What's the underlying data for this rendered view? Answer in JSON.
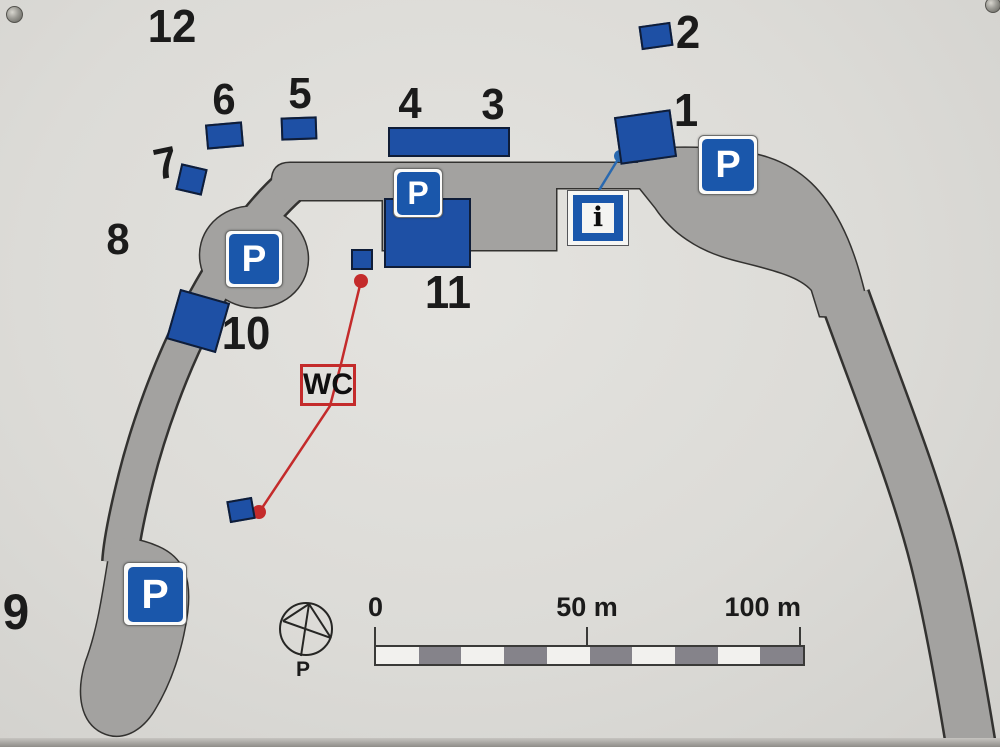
{
  "colors": {
    "background": "#dcdbd7",
    "road": "#a3a2a0",
    "road_outline": "#333230",
    "building": "#1e50a5",
    "building_outline": "#0f1d38",
    "sign_blue": "#1a57ab",
    "red": "#c42b2b",
    "connector_blue": "#2969b0",
    "ink": "#1b1b1b",
    "scale_gray": "#85838a",
    "scale_white": "#f2f1ee"
  },
  "labels": {
    "parking": "P",
    "info": "i",
    "wc": "WC",
    "compass_north": "P"
  },
  "site_numbers": [
    {
      "label": "12",
      "cx": 172,
      "cy": 26,
      "size": 46,
      "rotate": 0
    },
    {
      "label": "2",
      "cx": 688,
      "cy": 32,
      "size": 46,
      "rotate": 0
    },
    {
      "label": "6",
      "cx": 224,
      "cy": 100,
      "size": 44,
      "rotate": 0
    },
    {
      "label": "5",
      "cx": 300,
      "cy": 94,
      "size": 44,
      "rotate": 0
    },
    {
      "label": "4",
      "cx": 410,
      "cy": 104,
      "size": 44,
      "rotate": 0
    },
    {
      "label": "3",
      "cx": 493,
      "cy": 105,
      "size": 44,
      "rotate": 0
    },
    {
      "label": "1",
      "cx": 686,
      "cy": 110,
      "size": 46,
      "rotate": 0
    },
    {
      "label": "7",
      "cx": 166,
      "cy": 164,
      "size": 44,
      "rotate": -12
    },
    {
      "label": "8",
      "cx": 118,
      "cy": 240,
      "size": 44,
      "rotate": 0
    },
    {
      "label": "10",
      "cx": 246,
      "cy": 333,
      "size": 46,
      "rotate": 0
    },
    {
      "label": "11",
      "cx": 448,
      "cy": 292,
      "size": 46,
      "rotate": 0
    },
    {
      "label": "9",
      "cx": 16,
      "cy": 612,
      "size": 50,
      "rotate": 0
    }
  ],
  "buildings": [
    {
      "name": "building-2",
      "x": 640,
      "y": 24,
      "w": 32,
      "h": 24,
      "rotate": -8
    },
    {
      "name": "building-6",
      "x": 206,
      "y": 123,
      "w": 37,
      "h": 25,
      "rotate": -5
    },
    {
      "name": "building-5",
      "x": 281,
      "y": 117,
      "w": 36,
      "h": 23,
      "rotate": -2
    },
    {
      "name": "building-7",
      "x": 178,
      "y": 166,
      "w": 27,
      "h": 27,
      "rotate": 13
    },
    {
      "name": "building-3-4",
      "x": 388,
      "y": 127,
      "w": 122,
      "h": 30,
      "rotate": 0
    },
    {
      "name": "building-1",
      "x": 617,
      "y": 113,
      "w": 57,
      "h": 48,
      "rotate": -8
    },
    {
      "name": "building-10",
      "x": 172,
      "y": 295,
      "w": 52,
      "h": 52,
      "rotate": 16
    },
    {
      "name": "building-11",
      "x": 384,
      "y": 198,
      "w": 87,
      "h": 70,
      "rotate": 0
    },
    {
      "name": "building-11-annex",
      "x": 351,
      "y": 249,
      "w": 22,
      "h": 21,
      "rotate": 0
    },
    {
      "name": "wc-building",
      "x": 228,
      "y": 499,
      "w": 26,
      "h": 22,
      "rotate": -10
    }
  ],
  "parking_signs": [
    {
      "name": "parking-sign-northeast",
      "x": 698,
      "y": 135,
      "size": 60
    },
    {
      "name": "parking-sign-center",
      "x": 393,
      "y": 168,
      "size": 50
    },
    {
      "name": "parking-sign-west",
      "x": 225,
      "y": 230,
      "size": 58
    },
    {
      "name": "parking-sign-south",
      "x": 123,
      "y": 562,
      "size": 64
    }
  ],
  "scale_bar": {
    "labels": [
      "0",
      "50 m",
      "100 m"
    ],
    "segments": 10,
    "ticks_px": [
      0,
      213,
      425
    ]
  }
}
